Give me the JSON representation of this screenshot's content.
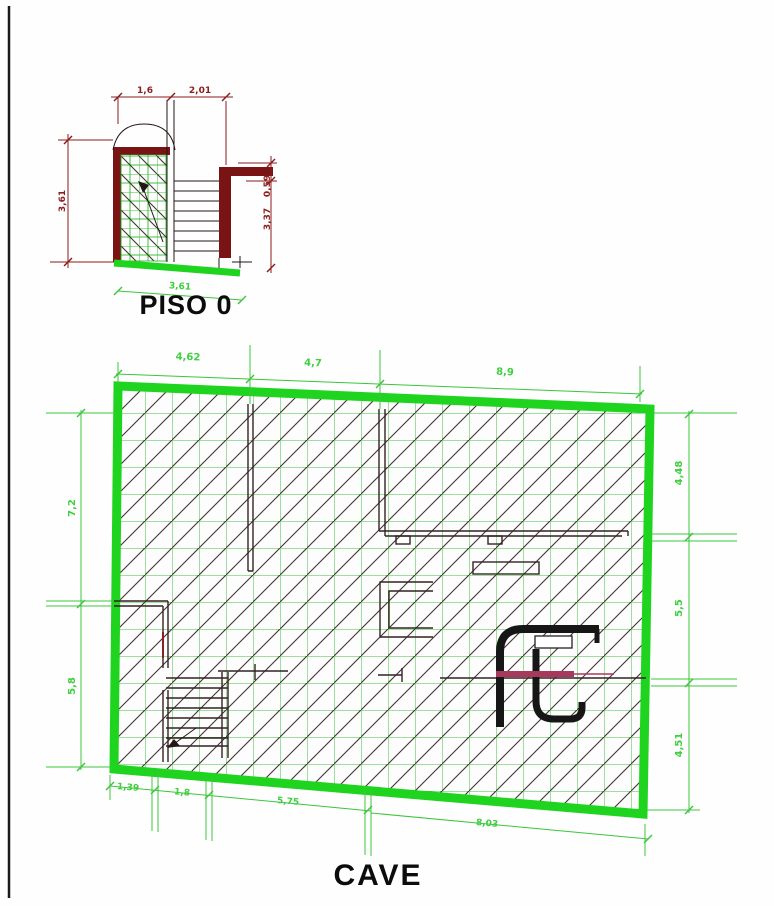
{
  "drawing": {
    "floor0": {
      "title": "PISO 0",
      "dim_top_1": "1,6",
      "dim_top_2": "2,01",
      "dim_left": "3,61",
      "dim_right_1": "0,59",
      "dim_right_2": "3,37",
      "dim_bottom": "3,61"
    },
    "basement": {
      "title": "CAVE",
      "dim_top_1": "4,62",
      "dim_top_2": "4,7",
      "dim_top_3": "8,9",
      "dim_left_1": "7,2",
      "dim_left_2": "5,8",
      "dim_right_1": "4,48",
      "dim_right_2": "5,5",
      "dim_right_3": "4,51",
      "dim_bottom_1": "1,39",
      "dim_bottom_2": "1,8",
      "dim_bottom_3": "5,75",
      "dim_bottom_4": "8,03"
    },
    "colors": {
      "wall_maroon": "#7a1414",
      "dim_maroon": "#8a1a1a",
      "bright_green": "#1fd41f",
      "grid_green": "#3ec03e",
      "dim_green": "#3cc53c",
      "hatch_dark": "#453232",
      "logo_black": "#161616",
      "accent_crimson": "#a8395c"
    }
  }
}
